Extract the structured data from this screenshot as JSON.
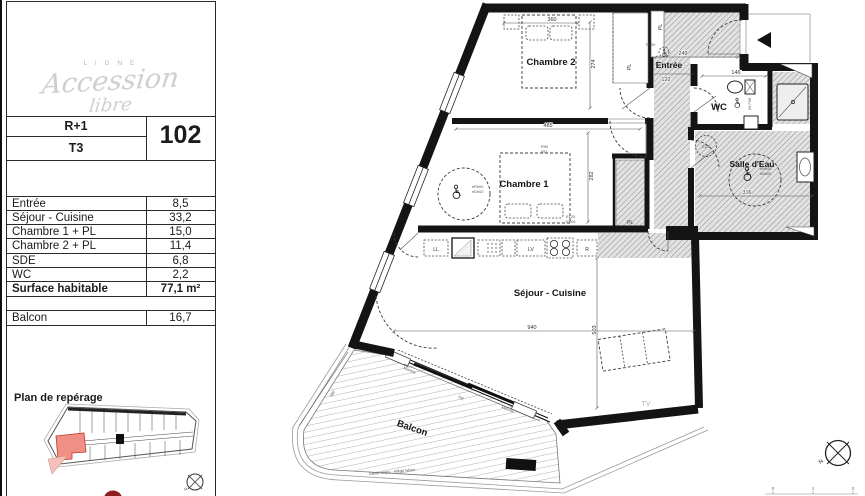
{
  "panel": {
    "logo": {
      "brand_top": "L I G N E",
      "brand_script1": "Accession",
      "brand_script2": "libre"
    },
    "unit": {
      "floor": "R+1",
      "type": "T3",
      "number": "102"
    },
    "areas": [
      {
        "label": "Entrée",
        "value": "8,5"
      },
      {
        "label": "Séjour - Cuisine",
        "value": "33,2"
      },
      {
        "label": "Chambre 1 + PL",
        "value": "15,0"
      },
      {
        "label": "Chambre 2 + PL",
        "value": "11,4"
      },
      {
        "label": "SDE",
        "value": "6,8"
      },
      {
        "label": "WC",
        "value": "2,2"
      }
    ],
    "total": {
      "label": "Surface habitable",
      "value": "77,1 m²"
    },
    "balcony_row": {
      "label": "Balcon",
      "value": "16,7"
    },
    "keyplan_title": "Plan de repérage"
  },
  "plan": {
    "rooms": {
      "chambre2": "Chambre 2",
      "chambre1": "Chambre 1",
      "entree": "Entrée",
      "wc": "WC",
      "sde": "Salle d'Eau",
      "sejour": "Séjour - Cuisine",
      "balcon": "Balcon"
    },
    "labels": {
      "pl": "PL",
      "ll": "LL",
      "lv": "LV",
      "r": "R",
      "ecs": "ECS",
      "tv": "TV",
      "marche": "Marche",
      "garde_corps": "Garde-corps - Allège béton",
      "north": "N"
    },
    "dims": {
      "d360": "360",
      "d274": "274",
      "d249": "249",
      "d122": "122",
      "d146": "146",
      "d485": "485",
      "d282": "282",
      "d316": "316",
      "d940": "940",
      "d503": "503",
      "d792": "792",
      "d382": "382"
    },
    "codes": {
      "erh": "eRh00",
      "edh": "eDh02",
      "e120": "E120",
      "eh01": "EH01",
      "r90": "R90",
      "o91": "091",
      "p08": "05 P08",
      "r00": "R+00"
    },
    "scalebar": {
      "t0": "0",
      "t1": "1",
      "t2": "2"
    }
  },
  "colors": {
    "wall": "#141414",
    "hatch_bg": "#e2e2e2",
    "hatch_line": "#8f8f8f",
    "highlight_red": "#ef8f86",
    "accent_red": "#8f1d1d",
    "logo_gray": "#c9c9c9"
  }
}
